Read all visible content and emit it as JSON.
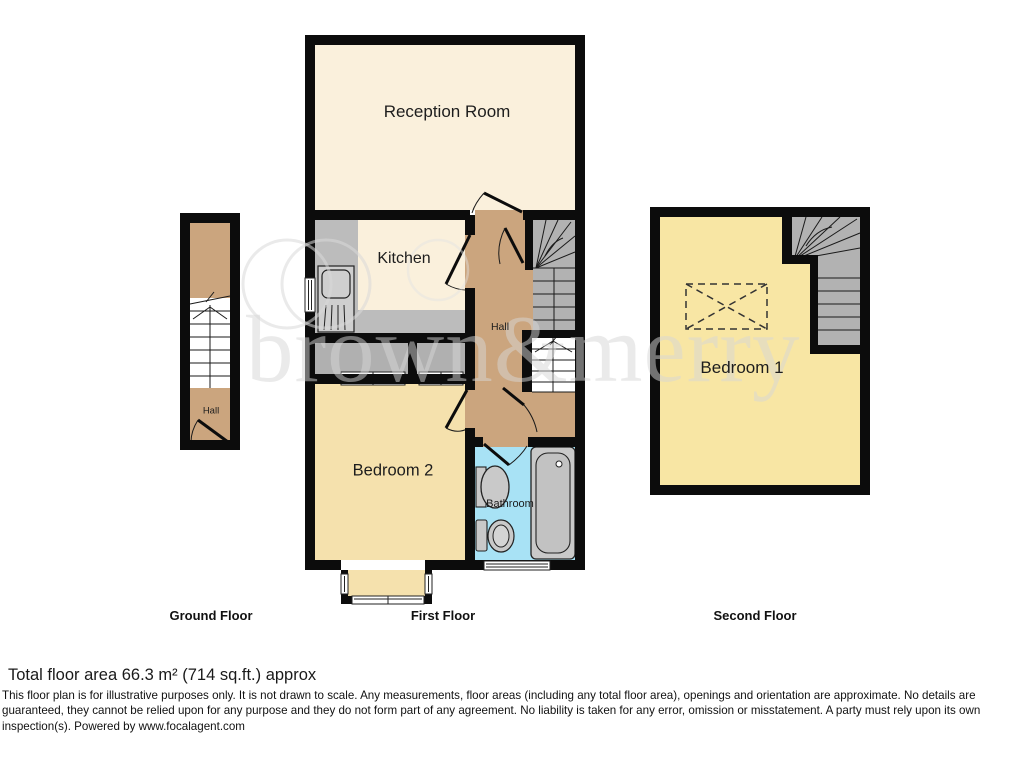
{
  "watermark": {
    "text": "brown&merry",
    "logo": "two-overlapping-circles"
  },
  "floors": {
    "ground": {
      "caption": "Ground Floor",
      "rooms": {
        "hall": "Hall"
      }
    },
    "first": {
      "caption": "First Floor",
      "rooms": {
        "reception": "Reception Room",
        "kitchen": "Kitchen",
        "hall": "Hall",
        "bedroom2": "Bedroom 2",
        "bathroom": "Bathroom"
      }
    },
    "second": {
      "caption": "Second Floor",
      "rooms": {
        "bedroom1": "Bedroom 1"
      }
    }
  },
  "footer": {
    "total_area": "Total floor area 66.3 m² (714 sq.ft.) approx",
    "disclaimer": "This floor plan is for illustrative purposes only. It is not drawn to scale. Any measurements, floor areas (including any total floor area), openings and orientation are approximate. No details are guaranteed, they cannot be relied upon for any purpose and they do not form part of any agreement. No liability is taken for any error, omission or misstatement. A party must rely upon its own inspection(s). Powered by www.focalagent.com"
  },
  "colors": {
    "wall": "#0c0c0c",
    "cream_room": "#faf0dc",
    "hall_tan": "#cba57e",
    "bedroom2_fill": "#f5e1ad",
    "bedroom1_fill": "#f8e6a4",
    "bathroom_fill": "#a8e2f5",
    "stairs_gray": "#b2b2b2",
    "counter_gray": "#bcbcbc"
  }
}
